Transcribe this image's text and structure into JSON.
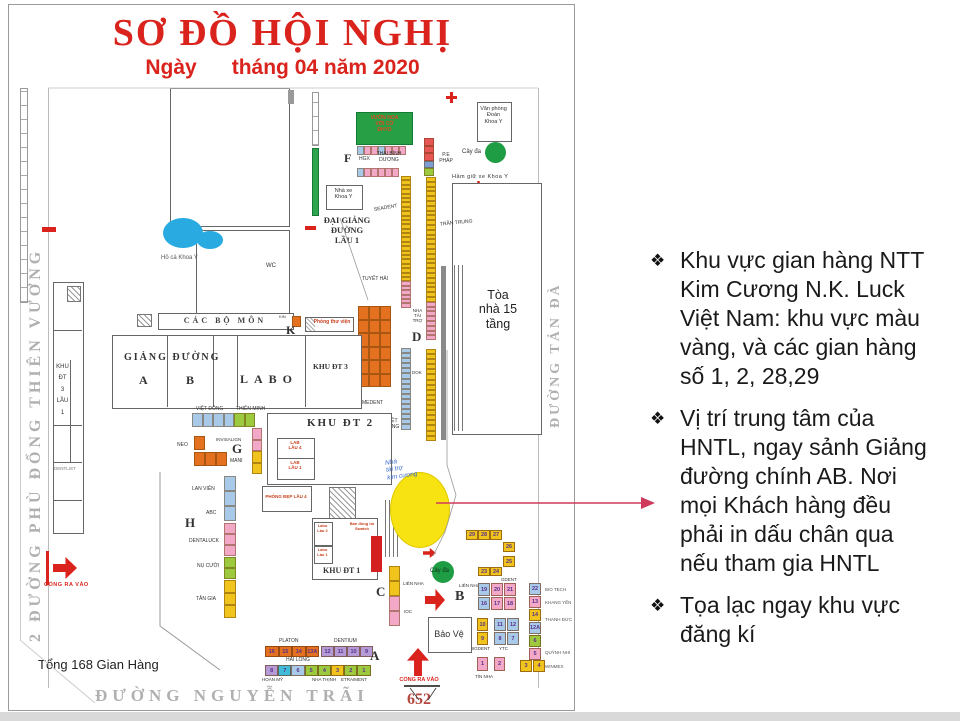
{
  "header": {
    "title": "SƠ ĐỒ HỘI NGHỊ",
    "date_line": "Ngày      tháng 04 năm 2020"
  },
  "streets": {
    "left": "2 ĐƯỜNG PHÙ ĐỔNG THIÊN VƯƠNG",
    "bottom": "ĐƯỜNG NGUYỄN TRÃI",
    "right": "ĐƯỜNG TẢN ĐÀ",
    "gate_number": "652"
  },
  "labels": {
    "tong": "Tổng 168 Gian Hàng",
    "cong_ra_vao": "CỔNG RA VÀO",
    "van_phong": "Văn phòng\nĐoàn\nKhoa Y",
    "cay_da_top": "Cây đa",
    "cay_da_bottom": "Cây đa",
    "ham_giu_xe": "Hầm giữ xe Khoa Y",
    "vuon_hoa": "VƯỜN HOA\nVỚI CỜ\nĐHYD",
    "f": "F",
    "hgx": "HGX",
    "thai_binh_duong": "THÁI BÌNH\nDƯƠNG",
    "pe_phap": "P.E\nPHÁP",
    "nha_xe": "Nhà xe\nKhoa Y",
    "dai_giang_duong": "ĐẠI GIẢNG\nĐƯỜNG\nLẦU 1",
    "ho_ca": "Hồ cá Khoa Y",
    "wc": "WC",
    "tran_trung": "TRẦN TRUNG",
    "toa_nha": "Tòa\nnhà 15\ntầng",
    "seadent": "SEADENT",
    "tuyet_hai": "TUYẾT HẢI",
    "nha_tai_tro": "NHA\nTÀI\nTRỢ",
    "k": "K",
    "kin": "KIN",
    "phong_thu_vien": "Phòng thư viện",
    "cac_bo_mon": "CÁC BỘ MÔN",
    "giang_duong": "GIẢNG ĐƯỜNG",
    "gd_a": "A",
    "gd_b": "B",
    "labo": "LABO",
    "khu_dt3": "KHU ĐT 3",
    "khu_dt3_lau1": "KHU\nĐT\n3\nLẦU\n1",
    "dentlist": "DENTLIST",
    "khu_dt2": "KHU ĐT 2",
    "lab_lau4": "LAB\nLẦU 4",
    "lab_lau1": "LAB\nLẦU 1",
    "phong_dep": "PHÒNG ĐẸP LẦU 4",
    "e": "E",
    "d": "D",
    "dok": "DOK",
    "medent": "MEDENT",
    "viet_dang": "VIỆT\nĐĂNG",
    "viet_dong": "VIỆT ĐÔNG",
    "thien_minh": "THIÊN MINH",
    "neo": "NEO",
    "invisalign": "INVISALIGN",
    "g": "G",
    "mani": "MANI",
    "lan_vien": "LAN VIÊN",
    "abc": "ABC",
    "h": "H",
    "dentaluck": "DENTALUCK",
    "nu_cuoi": "NỤ CƯỜI",
    "tan_gia": "TÂN GIA",
    "khu_dt1": "KHU ĐT 1",
    "labo_lau2": "Labo\nLầu 2",
    "labo_lau1": "Labo\nLầu 1",
    "ban_dong_ho": "Bán đồng hồ\nSwatch",
    "c": "C",
    "lien_nha_c": "LIÊN NHA",
    "ioc": "IOC",
    "sponsor": "Nhà\ntài trợ\nkim cương",
    "bao_ve": "Bảo Vệ",
    "b": "B",
    "lien_nha_b": "LIÊN NHA",
    "gdent": "GDENT",
    "bio_tech": "BIO TECH",
    "khang_yen": "KHANG YẾN",
    "thanh_duc": "THANH ĐỨC",
    "quynh_nhi": "QUỲNH NHI",
    "winmex": "WINMEX",
    "bigdent": "BIGDENT",
    "ytc": "YTC",
    "tin_nha": "TÍN NHA",
    "a": "A",
    "platon": "PLATON",
    "dentium": "DENTIUM",
    "hai_long": "HẢI LONG",
    "hoan_my": "HOÀN MỸ",
    "nha_thinh": "NHA THỊNH",
    "etraiment": "ETRAIMENT"
  },
  "strips": {
    "f_row1": [
      {
        "c": "#a9c9e8",
        "n": 1
      },
      {
        "c": "#f2a8c6",
        "n": 2
      },
      {
        "c": "#a9c9e8",
        "n": 1
      },
      {
        "c": "#f2a8c6",
        "n": 3
      }
    ],
    "f_row2": [
      {
        "c": "#a9c9e8",
        "n": 1
      },
      {
        "c": "#f2a8c6",
        "n": 5
      }
    ],
    "d_top": [
      {
        "c": "#e85555",
        "n": 3
      },
      {
        "c": "#7b9fd4",
        "n": 1
      },
      {
        "c": "#9dc93e",
        "n": 1
      }
    ],
    "e_strip": [
      {
        "c": "#f0c41c",
        "n": 24
      },
      {
        "c": "#f2a8c6",
        "n": 6
      }
    ],
    "d_strip": [
      {
        "c": "#f0c41c",
        "n": 26
      },
      {
        "c": "#f2a8c6",
        "n": 8
      }
    ],
    "e_lower": [
      {
        "c": "#a9c9e8",
        "n": 16
      }
    ],
    "d_lower": [
      {
        "c": "#f0c41c",
        "n": 18
      }
    ],
    "orange_block": [
      {
        "c": "#e4711f",
        "n": 18
      }
    ],
    "kin_cell": [
      {
        "c": "#e4711f",
        "n": 1
      }
    ],
    "g_row": [
      {
        "c": "#a9c9e8",
        "n": 4
      },
      {
        "c": "#9dc93e",
        "n": 2
      }
    ],
    "neo_cell": [
      {
        "c": "#e4711f",
        "n": 1
      }
    ],
    "neo_row": [
      {
        "c": "#e4711f",
        "n": 3
      }
    ],
    "g_col": [
      {
        "c": "#f2a8c6",
        "n": 2
      },
      {
        "c": "#f0c41c",
        "n": 2
      }
    ],
    "h_col_blue": [
      {
        "c": "#a9c9e8",
        "n": 3
      }
    ],
    "h_col_pink": [
      {
        "c": "#f2a8c6",
        "n": 3
      }
    ],
    "h_col_green": [
      {
        "c": "#9dc93e",
        "n": 2
      }
    ],
    "h_col_yellow": [
      {
        "c": "#f0c41c",
        "n": 3
      }
    ],
    "c_col": [
      {
        "c": "#f0c41c",
        "n": 2
      },
      {
        "c": "#f2a8c6",
        "n": 2
      }
    ]
  },
  "clusters": {
    "row_29_28_27": [
      {
        "t": "29",
        "c": "#f0c41c"
      },
      {
        "t": "28",
        "c": "#f0c41c"
      },
      {
        "t": "27",
        "c": "#f0c41c"
      }
    ],
    "cell_26": [
      {
        "t": "26",
        "c": "#f0c41c"
      }
    ],
    "cell_25": [
      {
        "t": "25",
        "c": "#f0c41c"
      }
    ],
    "row_23_24": [
      {
        "t": "23",
        "c": "#f0c41c"
      },
      {
        "t": "24",
        "c": "#f0c41c"
      }
    ],
    "lien_nha_grid": [
      {
        "t": "19",
        "c": "#a9c9e8"
      },
      {
        "t": "20",
        "c": "#f2a8c6"
      },
      {
        "t": "21",
        "c": "#f2a8c6"
      },
      {
        "t": "16",
        "c": "#a9c9e8"
      },
      {
        "t": "17",
        "c": "#f2a8c6"
      },
      {
        "t": "18",
        "c": "#f2a8c6"
      }
    ],
    "right_col": [
      {
        "t": "22",
        "c": "#a9c9e8"
      },
      {
        "t": "13",
        "c": "#f2a8c6"
      },
      {
        "t": "14",
        "c": "#f0c41c"
      },
      {
        "t": "12A",
        "c": "#a9c9e8"
      },
      {
        "t": "6",
        "c": "#9dc93e"
      },
      {
        "t": "5",
        "c": "#f2a8c6"
      }
    ],
    "pair_3_4": [
      {
        "t": "3",
        "c": "#f0c41c"
      },
      {
        "t": "4",
        "c": "#f0c41c"
      }
    ],
    "bigdent_col": [
      {
        "t": "10",
        "c": "#f0c41c"
      },
      {
        "t": "9",
        "c": "#f0c41c"
      }
    ],
    "ytc_grid": [
      {
        "t": "11",
        "c": "#a9c9e8"
      },
      {
        "t": "12",
        "c": "#a9c9e8"
      },
      {
        "t": "8",
        "c": "#a9c9e8"
      },
      {
        "t": "7",
        "c": "#a9c9e8"
      }
    ],
    "tin_row": [
      {
        "t": "1",
        "c": "#f2a8c6"
      },
      {
        "t": "2",
        "c": "#f2a8c6"
      }
    ],
    "platon_row": [
      {
        "t": "16",
        "c": "#e4711f"
      },
      {
        "t": "15",
        "c": "#e4711f"
      },
      {
        "t": "14",
        "c": "#e4711f"
      },
      {
        "t": "13A",
        "c": "#e4711f"
      }
    ],
    "dentium_row": [
      {
        "t": "12",
        "c": "#b49bd6"
      },
      {
        "t": "11",
        "c": "#b49bd6"
      },
      {
        "t": "10",
        "c": "#b49bd6"
      },
      {
        "t": "9",
        "c": "#b49bd6"
      }
    ],
    "hai_long_row": [
      {
        "t": "8",
        "c": "#b49bd6"
      },
      {
        "t": "7",
        "c": "#40bcd8"
      },
      {
        "t": "6",
        "c": "#a9c9e8"
      },
      {
        "t": "5",
        "c": "#9dc93e"
      },
      {
        "t": "4",
        "c": "#9dc93e"
      },
      {
        "t": "3",
        "c": "#f0c41c"
      },
      {
        "t": "2",
        "c": "#9dc93e"
      },
      {
        "t": "1",
        "c": "#9dc93e"
      }
    ]
  },
  "notes": {
    "bullets": [
      {
        "marker": "❖",
        "text": "Khu vực gian hàng NTT\nKim Cương N.K. Luck\nViệt Nam: khu vực màu\nvàng, và các gian hàng\nsố 1, 2, 28,29"
      },
      {
        "marker": "❖",
        "text": "Vị trí trung tâm của\nHNTL, ngay sảnh Giảng\nđường  chính AB. Nơi\nmọi Khách hàng đều\nphải in dấu chân qua\nnếu tham gia HNTL"
      },
      {
        "marker": "❖",
        "text": "Tọa lạc ngay khu vực\nđăng kí"
      }
    ]
  },
  "colors": {
    "title_red": "#d9231c",
    "stall_yellow": "#f0c41c",
    "stall_pink": "#f2a8c6",
    "stall_blue": "#a9c9e8",
    "stall_orange": "#e4711f",
    "stall_green": "#9dc93e",
    "stall_purple": "#b49bd6",
    "tree_green": "#1f9d44",
    "pond_blue": "#29abe2",
    "sponsor_yellow": "#f7e311",
    "arrow_pink": "#cf3a5c"
  }
}
